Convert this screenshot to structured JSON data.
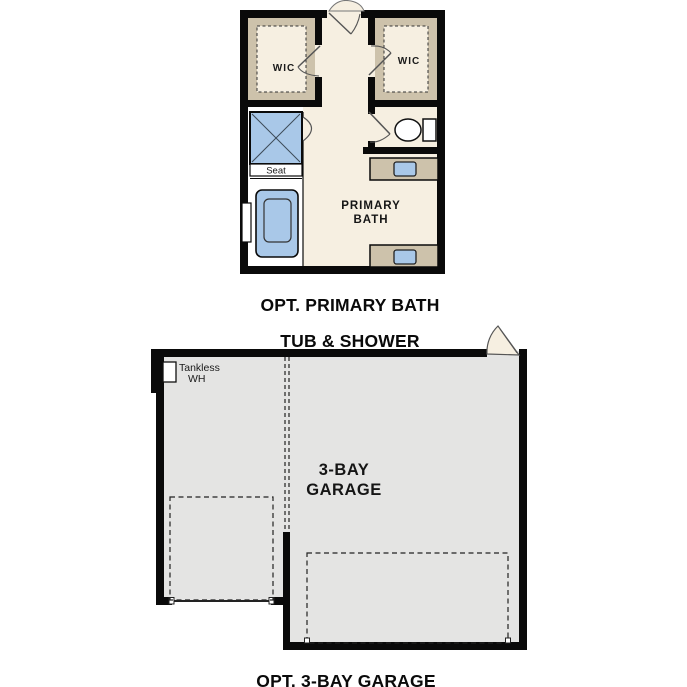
{
  "palette": {
    "wall_black": "#0a0a0a",
    "floor_cream": "#f6efe1",
    "shelf_tan": "#cdc2ab",
    "fixture_blue": "#a9c8e8",
    "garage_gray": "#e4e4e3",
    "wet_zone_white": "#ffffff",
    "door_gray": "#555555",
    "dash_dark": "#222222"
  },
  "bath_plan": {
    "caption": [
      "OPT. PRIMARY BATH",
      "TUB & SHOWER"
    ],
    "room_label": [
      "PRIMARY",
      "BATH"
    ],
    "wic_left_label": "WIC",
    "wic_right_label": "WIC",
    "seat_label": "Seat"
  },
  "garage_plan": {
    "caption": "OPT. 3-BAY GARAGE",
    "room_label": [
      "3-BAY",
      "GARAGE"
    ],
    "tankless_label": [
      "Tankless",
      "WH"
    ]
  }
}
